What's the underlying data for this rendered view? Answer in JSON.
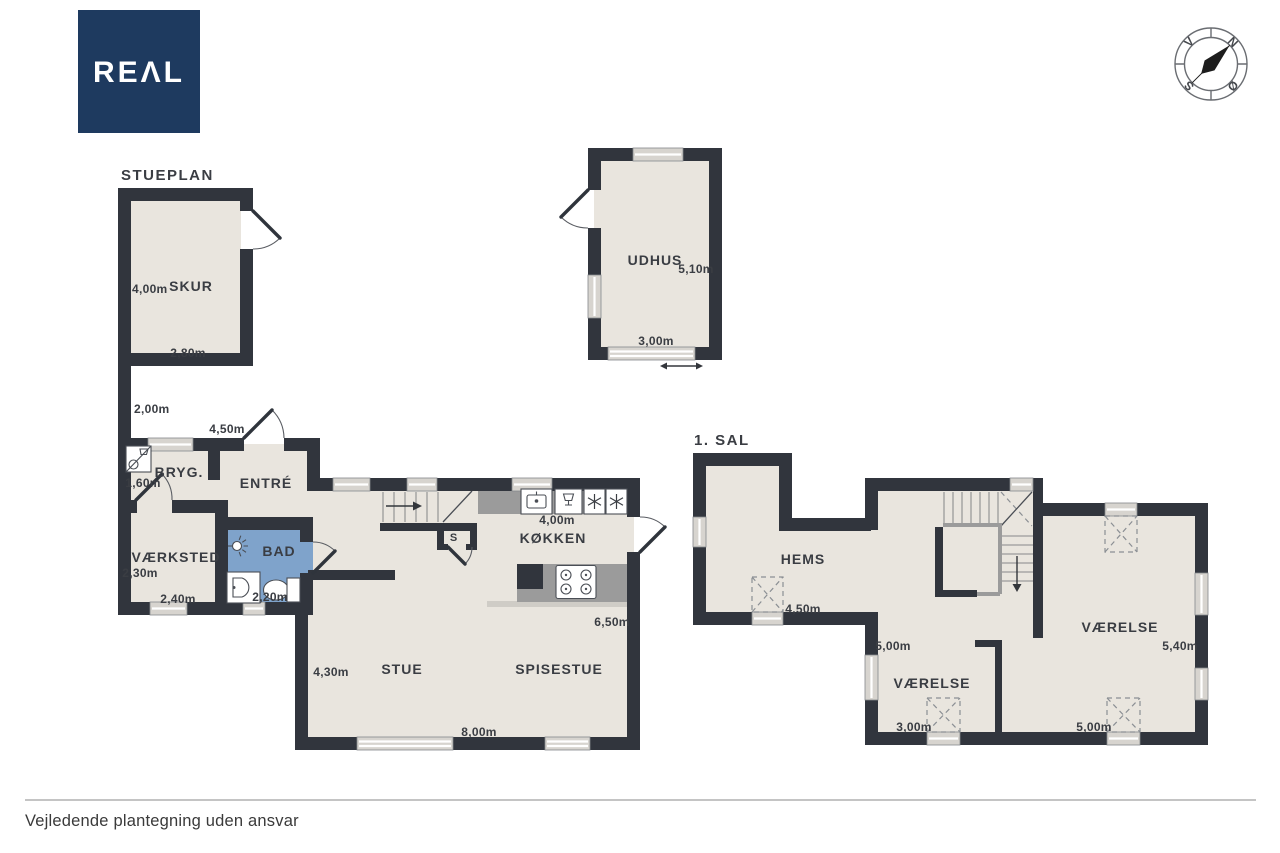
{
  "brand": {
    "name": "REAL",
    "display": "REΛL",
    "navy": "#1e3a5f"
  },
  "titles": {
    "ground": "STUEPLAN",
    "first": "1. SAL"
  },
  "footer": {
    "disclaimer": "Vejledende plantegning uden ansvar"
  },
  "compass": {
    "north": "N",
    "east": "Ø",
    "south": "S",
    "west": "V"
  },
  "colors": {
    "wall": "#31353d",
    "floor": "#e9e5de",
    "bath_floor": "#7fa3cb",
    "counter": "#9b9b9b",
    "window": "#d7d4cf"
  },
  "ground": {
    "skur": {
      "name": "SKUR",
      "height": "4,00m",
      "width": "2,80m"
    },
    "wall_segment": {
      "length": "2,00m"
    },
    "entre": {
      "name": "ENTRÉ",
      "width": "4,50m"
    },
    "bryg": {
      "name": "BRYG.",
      "width": "1,60m"
    },
    "vaerksted": {
      "name": "VÆRKSTED",
      "height": "2,30m",
      "width": "2,40m"
    },
    "bad": {
      "name": "BAD",
      "width": "2,20m"
    },
    "koekken": {
      "name": "KØKKEN",
      "width": "4,00m",
      "height": "6,50m"
    },
    "stue": {
      "name": "STUE",
      "height": "4,30m",
      "width": "8,00m"
    },
    "spisestue": {
      "name": "SPISESTUE"
    },
    "closet": {
      "name": "S"
    },
    "udhus": {
      "name": "UDHUS",
      "height": "5,10m",
      "width": "3,00m"
    }
  },
  "first": {
    "hems": {
      "name": "HEMS",
      "width": "4,50m"
    },
    "vaerelse_large": {
      "name": "VÆRELSE",
      "height": "5,40m",
      "width": "5,00m"
    },
    "vaerelse_small": {
      "name": "VÆRELSE",
      "height": "5,00m",
      "width": "3,00m"
    }
  }
}
